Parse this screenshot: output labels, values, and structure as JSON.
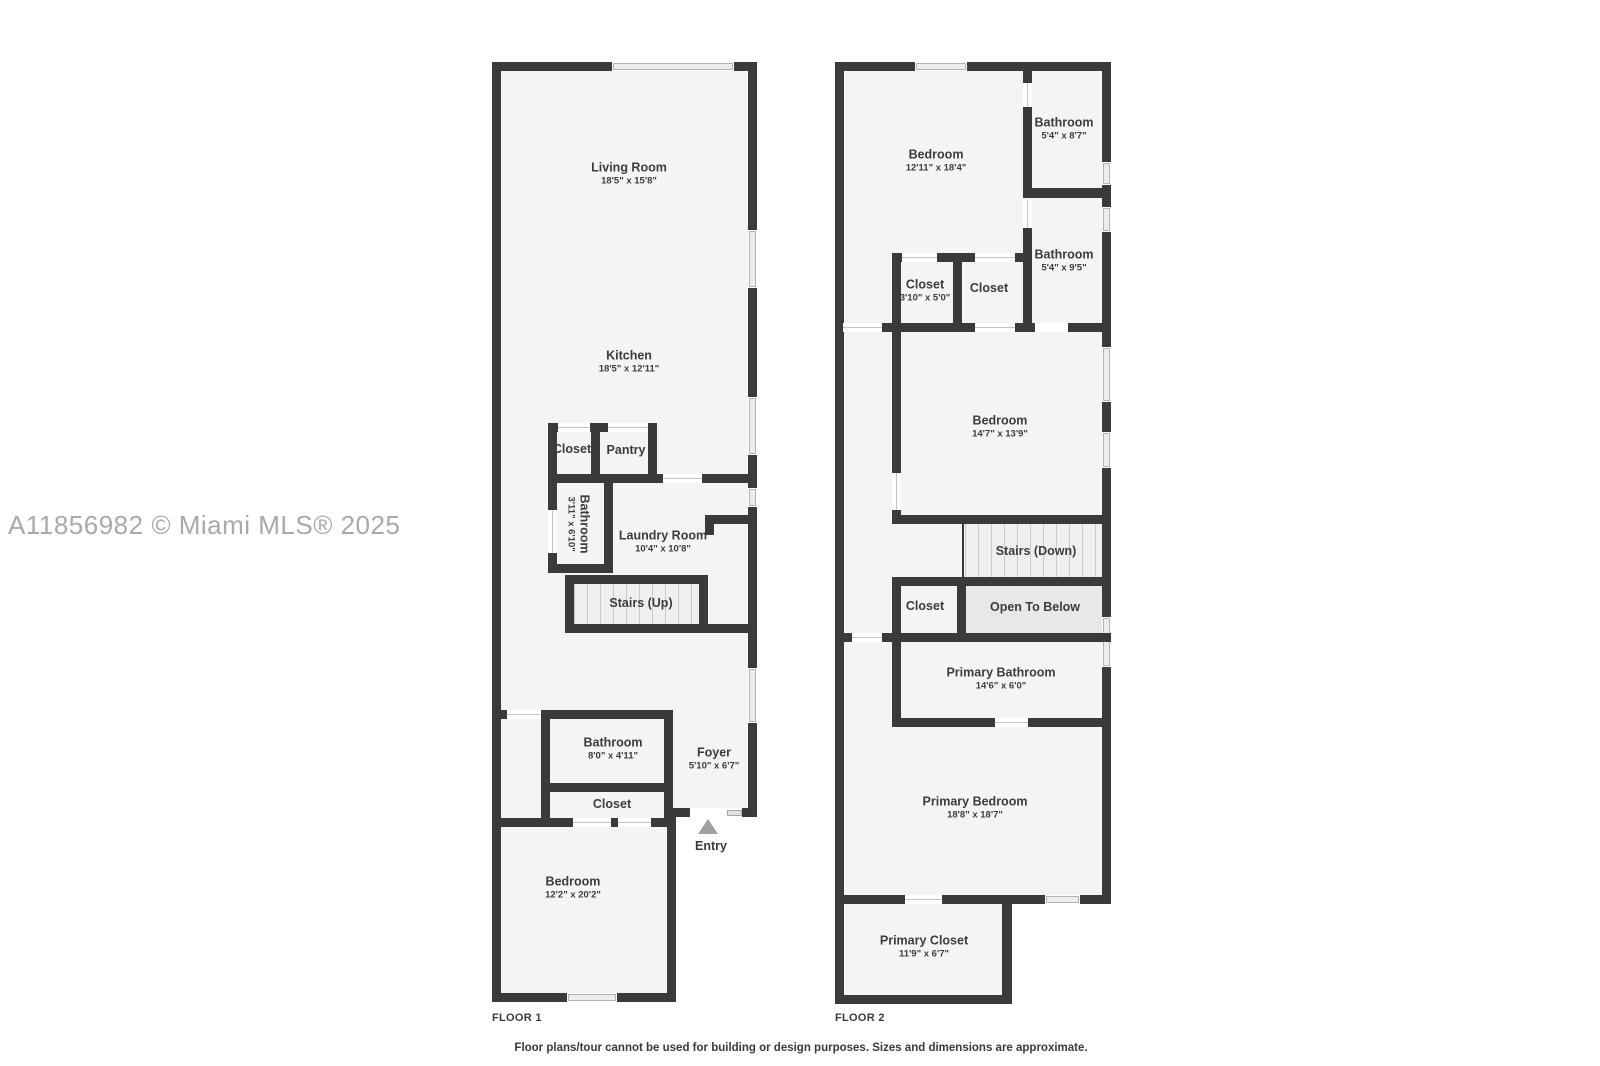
{
  "watermark": "A11856982 © Miami MLS® 2025",
  "footer": "Floor plans/tour cannot be used for building or design purposes. Sizes and dimensions are approximate.",
  "colors": {
    "wall": "#3a3a3a",
    "room_fill": "#f4f4f4",
    "open_to_below_fill": "#e8e8e8",
    "door_line": "#c4c4c4",
    "window_fill": "#ececec",
    "label_text": "#3c3c3c",
    "watermark_text": "#a9a9a9",
    "entry_arrow": "#9f9f9f"
  },
  "floor1": {
    "label": "FLOOR 1",
    "rooms": {
      "living_room": {
        "name": "Living Room",
        "dims": "18'5\" x 15'8\""
      },
      "kitchen": {
        "name": "Kitchen",
        "dims": "18'5\" x 12'11\""
      },
      "closet": {
        "name": "Closet"
      },
      "pantry": {
        "name": "Pantry"
      },
      "bathroom_mid": {
        "name": "Bathroom",
        "dims": "3'11\" x 6'10\""
      },
      "laundry": {
        "name": "Laundry Room",
        "dims": "10'4\" x 10'8\""
      },
      "stairs": {
        "name": "Stairs (Up)"
      },
      "bathroom_lower": {
        "name": "Bathroom",
        "dims": "8'0\" x 4'11\""
      },
      "foyer": {
        "name": "Foyer",
        "dims": "5'10\" x 6'7\""
      },
      "closet_lower": {
        "name": "Closet"
      },
      "entry": {
        "name": "Entry"
      },
      "bedroom": {
        "name": "Bedroom",
        "dims": "12'2\" x 20'2\""
      }
    }
  },
  "floor2": {
    "label": "FLOOR 2",
    "rooms": {
      "bedroom1": {
        "name": "Bedroom",
        "dims": "12'11\" x 18'4\""
      },
      "bathroom1": {
        "name": "Bathroom",
        "dims": "5'4\" x 8'7\""
      },
      "bathroom2": {
        "name": "Bathroom",
        "dims": "5'4\" x 9'5\""
      },
      "closet1": {
        "name": "Closet",
        "dims": "3'10\" x 5'0\""
      },
      "closet2": {
        "name": "Closet"
      },
      "bedroom2": {
        "name": "Bedroom",
        "dims": "14'7\" x 13'9\""
      },
      "stairs": {
        "name": "Stairs (Down)"
      },
      "closet3": {
        "name": "Closet"
      },
      "open_below": {
        "name": "Open To Below"
      },
      "primary_bathroom": {
        "name": "Primary Bathroom",
        "dims": "14'6\" x 6'0\""
      },
      "primary_bedroom": {
        "name": "Primary Bedroom",
        "dims": "18'8\" x 18'7\""
      },
      "primary_closet": {
        "name": "Primary Closet",
        "dims": "11'9\" x 6'7\""
      }
    }
  }
}
